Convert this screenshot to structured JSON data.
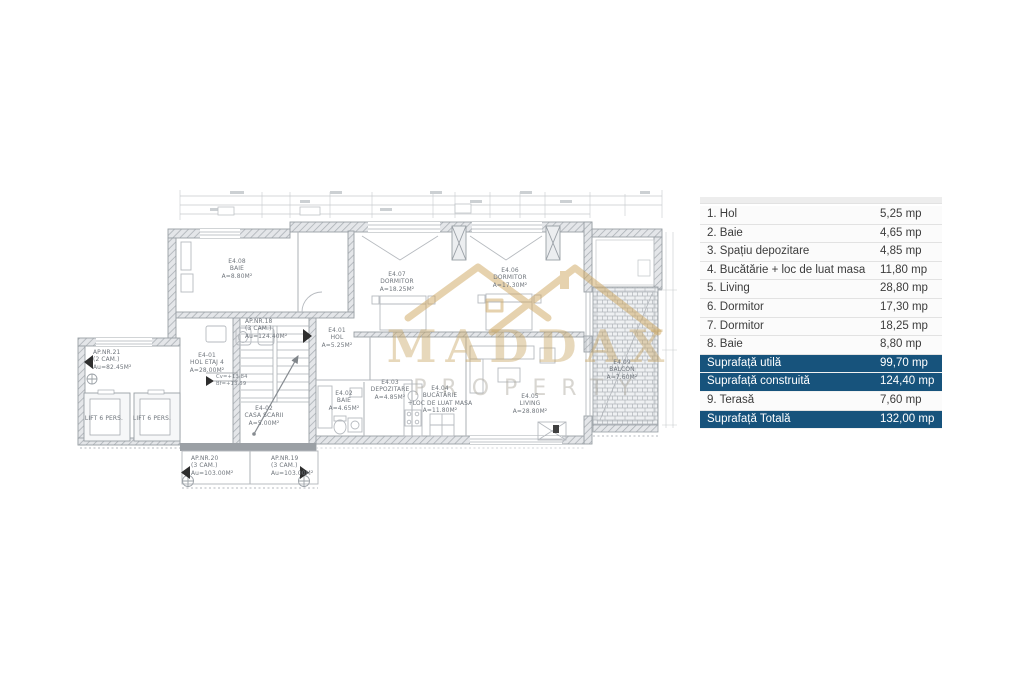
{
  "table": {
    "highlight_color": "#17537c",
    "text_color": "#3c3c3c",
    "unit": "mp",
    "rows": [
      {
        "label": "1. Hol",
        "value": "5,25 mp",
        "highlight": false
      },
      {
        "label": "2. Baie",
        "value": "4,65 mp",
        "highlight": false
      },
      {
        "label": "3. Spațiu depozitare",
        "value": "4,85 mp",
        "highlight": false
      },
      {
        "label": "4. Bucătărie + loc de luat masa",
        "value": "11,80 mp",
        "highlight": false
      },
      {
        "label": "5. Living",
        "value": "28,80 mp",
        "highlight": false
      },
      {
        "label": "6. Dormitor",
        "value": "17,30 mp",
        "highlight": false
      },
      {
        "label": "7. Dormitor",
        "value": "18,25 mp",
        "highlight": false
      },
      {
        "label": "8. Baie",
        "value": "8,80 mp",
        "highlight": false
      },
      {
        "label": "Suprafață utilă",
        "value": "99,70 mp",
        "highlight": true
      },
      {
        "label": "Suprafață construită",
        "value": "124,40 mp",
        "highlight": true
      },
      {
        "label": "9. Terasă",
        "value": "7,60 mp",
        "highlight": false
      },
      {
        "label": "Suprafață Totală",
        "value": "132,00 mp",
        "highlight": true
      }
    ]
  },
  "watermark": {
    "brand": "MADDAX",
    "sub": "PROPERTY",
    "color": "#c5a25e"
  },
  "plan": {
    "labels": [
      {
        "id": "e408",
        "lines": [
          "E4.08",
          "BAIE",
          "A=8.80M²"
        ]
      },
      {
        "id": "e407",
        "lines": [
          "E4.07",
          "DORMITOR",
          "A=18.25M²"
        ]
      },
      {
        "id": "e406",
        "lines": [
          "E4.06",
          "DORMITOR",
          "A=17.30M²"
        ]
      },
      {
        "id": "e401",
        "lines": [
          "E4.01",
          "HOL",
          "A=5.25M²"
        ]
      },
      {
        "id": "e402",
        "lines": [
          "E4.02",
          "BAIE",
          "A=4.65M²"
        ]
      },
      {
        "id": "e403",
        "lines": [
          "E4.03",
          "DEPOZITARE",
          "A=4.85M²"
        ]
      },
      {
        "id": "e404",
        "lines": [
          "E4.04",
          "BUCĂTĂRIE",
          "+LOC DE LUAT MASA",
          "A=11.80M²"
        ]
      },
      {
        "id": "e405",
        "lines": [
          "E4.05",
          "LIVING",
          "A=28.80M²"
        ]
      },
      {
        "id": "e409",
        "lines": [
          "E4.09",
          "BALCON",
          "A=7.60M²"
        ]
      },
      {
        "id": "ap21",
        "lines": [
          "AP.NR.21",
          "(2 CAM.)",
          "Au=82.45M²"
        ]
      },
      {
        "id": "holetaj",
        "lines": [
          "E4-01",
          "HOL ETAJ 4",
          "A=28.00M²"
        ]
      },
      {
        "id": "cota",
        "lines": [
          "Cv=+13.84",
          "Bf=+13.59"
        ]
      },
      {
        "id": "lift1",
        "lines": [
          "LIFT 6 PERS."
        ]
      },
      {
        "id": "lift2",
        "lines": [
          "LIFT 6 PERS."
        ]
      },
      {
        "id": "ap18",
        "lines": [
          "AP.NR.18",
          "(3 CAM.)",
          "Au=124.40M²"
        ]
      },
      {
        "id": "casascarii",
        "lines": [
          "E4-02",
          "CASA SCARII",
          "A=5.00M²"
        ]
      },
      {
        "id": "ap20",
        "lines": [
          "AP.NR.20",
          "(3 CAM.)",
          "Au=103.00M²"
        ]
      },
      {
        "id": "ap19",
        "lines": [
          "AP.NR.19",
          "(3 CAM.)",
          "Au=103.00M²"
        ]
      }
    ]
  }
}
